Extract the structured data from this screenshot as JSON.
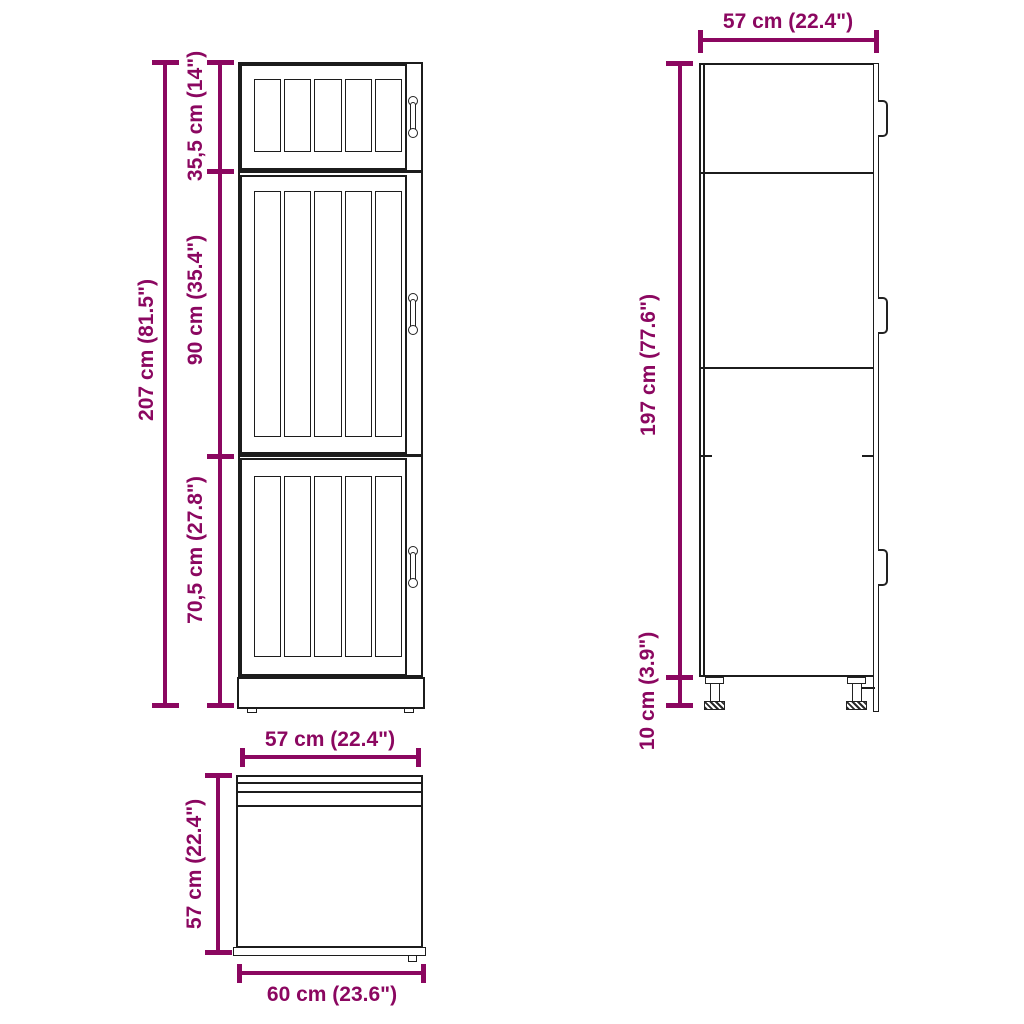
{
  "colors": {
    "dimension": "#8B0760",
    "line": "#1c1c1c",
    "background": "#ffffff"
  },
  "front_view": {
    "total_height_label": "207 cm (81.5\")",
    "top_section_label": "35,5 cm (14\")",
    "middle_section_label": "90 cm (35.4\")",
    "bottom_section_label": "70,5 cm (27.8\")"
  },
  "side_view": {
    "depth_label": "57 cm (22.4\")",
    "body_height_label": "197 cm (77.6\")",
    "legs_height_label": "10 cm (3.9\")"
  },
  "top_view": {
    "body_width_label": "57 cm (22.4\")",
    "depth_label": "57 cm (22.4\")",
    "overall_width_label": "60 cm (23.6\")"
  }
}
